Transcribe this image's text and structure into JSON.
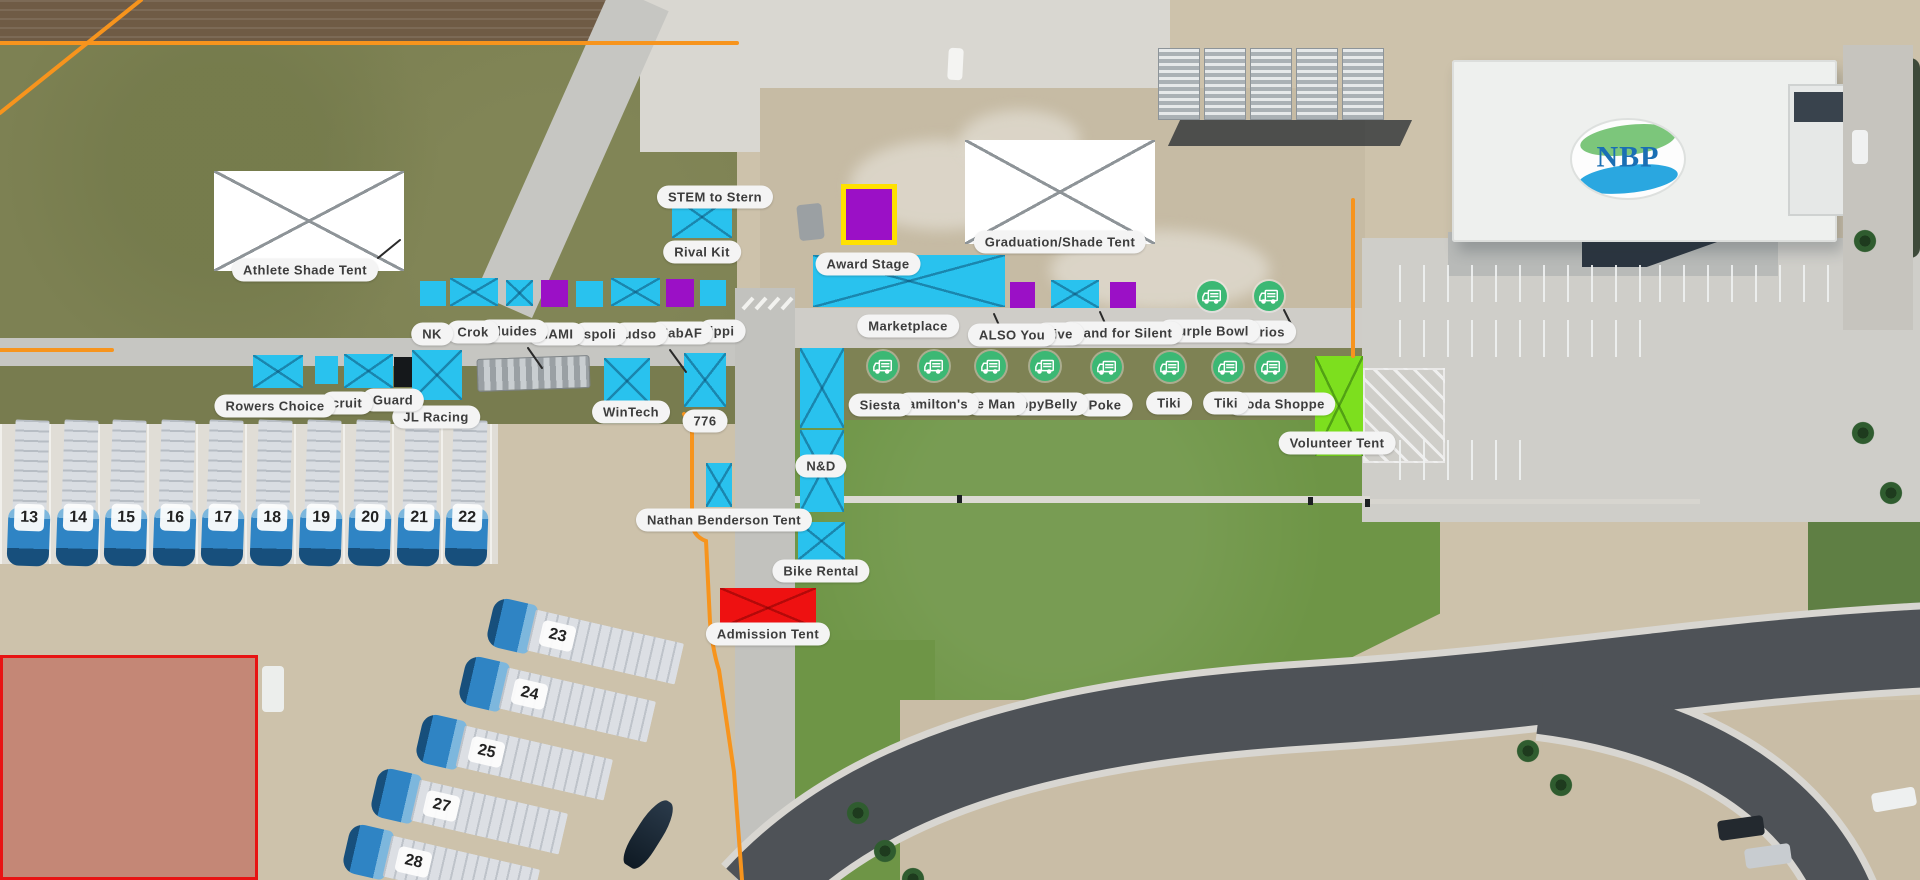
{
  "colors": {
    "tent-cyan": "#29c2ee",
    "tent-purple": "#9b10c6",
    "tent-red": "#ee1111",
    "tent-lime": "#7ddf1e",
    "stage-yellow": "#ffe100",
    "truck-green": "#3cb874",
    "boundary-orange": "#f7941d",
    "label-bg": "#f4f4f4",
    "label-text": "#3d3d3d",
    "zone-red": "#e81313"
  },
  "logo": {
    "text": "NBP"
  },
  "map": {
    "labels": [
      {
        "t": "Athlete Shade Tent",
        "x": 305,
        "y": 270
      },
      {
        "t": "STEM to Stern",
        "x": 715,
        "y": 197
      },
      {
        "t": "Rival Kit",
        "x": 702,
        "y": 252
      },
      {
        "t": "Award Stage",
        "x": 868,
        "y": 264
      },
      {
        "t": "Graduation/Shade Tent",
        "x": 1060,
        "y": 242
      },
      {
        "t": "Marketplace",
        "x": 908,
        "y": 326
      },
      {
        "t": "NK",
        "x": 432,
        "y": 334
      },
      {
        "t": "Crok",
        "x": 473,
        "y": 332
      },
      {
        "t": "Fluides",
        "x": 513,
        "y": 331
      },
      {
        "t": "NAMI",
        "x": 556,
        "y": 334
      },
      {
        "t": "spoli",
        "x": 600,
        "y": 334
      },
      {
        "t": "udso",
        "x": 640,
        "y": 334
      },
      {
        "t": "FabAF",
        "x": 681,
        "y": 333
      },
      {
        "t": "ippi",
        "x": 722,
        "y": 331
      },
      {
        "t": "ALSO You",
        "x": 1012,
        "y": 335
      },
      {
        "t": "Live",
        "x": 1059,
        "y": 334
      },
      {
        "t": "Stand for Silent",
        "x": 1121,
        "y": 333
      },
      {
        "t": "Purple Bowl",
        "x": 1209,
        "y": 331
      },
      {
        "t": "Frios",
        "x": 1268,
        "y": 332
      },
      {
        "t": "Rowers Choice",
        "x": 275,
        "y": 406
      },
      {
        "t": "cruit",
        "x": 347,
        "y": 403
      },
      {
        "t": "Guard",
        "x": 393,
        "y": 400
      },
      {
        "t": "JL Racing",
        "x": 436,
        "y": 417
      },
      {
        "t": "WinTech",
        "x": 631,
        "y": 412
      },
      {
        "t": "776",
        "x": 705,
        "y": 421
      },
      {
        "t": "Siesta",
        "x": 880,
        "y": 405
      },
      {
        "t": "amilton's",
        "x": 938,
        "y": 404
      },
      {
        "t": "e Man",
        "x": 996,
        "y": 404
      },
      {
        "t": "ppyBelly",
        "x": 1049,
        "y": 404
      },
      {
        "t": "Poke",
        "x": 1105,
        "y": 405
      },
      {
        "t": "Tiki",
        "x": 1169,
        "y": 403
      },
      {
        "t": "Tiki",
        "x": 1226,
        "y": 403
      },
      {
        "t": "Soda Shoppe",
        "x": 1281,
        "y": 404
      },
      {
        "t": "Volunteer Tent",
        "x": 1337,
        "y": 443
      },
      {
        "t": "N&D",
        "x": 821,
        "y": 466
      },
      {
        "t": "Nathan Benderson Tent",
        "x": 724,
        "y": 520
      },
      {
        "t": "Bike Rental",
        "x": 821,
        "y": 571
      },
      {
        "t": "Admission Tent",
        "x": 768,
        "y": 634
      }
    ],
    "tents": [
      {
        "n": "athlete-shade-tent",
        "c": "white",
        "x": 214,
        "y": 171,
        "w": 190,
        "h": 100,
        "xm": true
      },
      {
        "n": "graduation-shade-tent",
        "c": "white",
        "x": 965,
        "y": 140,
        "w": 190,
        "h": 104,
        "xm": true
      },
      {
        "n": "stage-square",
        "c": "purple",
        "x": 841,
        "y": 184,
        "w": 56,
        "h": 61,
        "border": "yellow"
      },
      {
        "n": "award-stage",
        "c": "cyan",
        "x": 813,
        "y": 255,
        "w": 192,
        "h": 52,
        "xm": true
      },
      {
        "n": "stem-to-stern-tent",
        "c": "cyan",
        "x": 672,
        "y": 196,
        "w": 60,
        "h": 42,
        "xm": true
      },
      {
        "n": "vendor-tent",
        "c": "cyan",
        "x": 420,
        "y": 281,
        "w": 26,
        "h": 25
      },
      {
        "n": "vendor-tent",
        "c": "cyan",
        "x": 450,
        "y": 278,
        "w": 48,
        "h": 28,
        "xm": true
      },
      {
        "n": "vendor-tent",
        "c": "cyan",
        "x": 506,
        "y": 280,
        "w": 27,
        "h": 26,
        "xm": true
      },
      {
        "n": "vendor-tent",
        "c": "purple",
        "x": 541,
        "y": 280,
        "w": 27,
        "h": 27
      },
      {
        "n": "vendor-tent",
        "c": "cyan",
        "x": 576,
        "y": 281,
        "w": 27,
        "h": 26
      },
      {
        "n": "vendor-tent",
        "c": "cyan",
        "x": 611,
        "y": 278,
        "w": 49,
        "h": 28,
        "xm": true
      },
      {
        "n": "vendor-tent",
        "c": "purple",
        "x": 666,
        "y": 279,
        "w": 28,
        "h": 28
      },
      {
        "n": "vendor-tent",
        "c": "cyan",
        "x": 700,
        "y": 280,
        "w": 26,
        "h": 26
      },
      {
        "n": "vendor-tent",
        "c": "purple",
        "x": 1010,
        "y": 282,
        "w": 25,
        "h": 26
      },
      {
        "n": "vendor-tent",
        "c": "cyan",
        "x": 1051,
        "y": 280,
        "w": 48,
        "h": 28,
        "xm": true
      },
      {
        "n": "vendor-tent",
        "c": "purple",
        "x": 1110,
        "y": 282,
        "w": 26,
        "h": 26
      },
      {
        "n": "vendor-tent",
        "c": "cyan",
        "x": 253,
        "y": 355,
        "w": 50,
        "h": 33,
        "xm": true
      },
      {
        "n": "vendor-tent",
        "c": "cyan",
        "x": 315,
        "y": 356,
        "w": 23,
        "h": 28
      },
      {
        "n": "vendor-tent",
        "c": "cyan",
        "x": 344,
        "y": 354,
        "w": 49,
        "h": 34,
        "xm": true
      },
      {
        "n": "vendor-tent",
        "c": "black",
        "x": 394,
        "y": 357,
        "w": 18,
        "h": 30
      },
      {
        "n": "vendor-tent",
        "c": "cyan",
        "x": 412,
        "y": 350,
        "w": 50,
        "h": 50,
        "xm": true
      },
      {
        "n": "wintech-tent",
        "c": "cyan",
        "x": 604,
        "y": 358,
        "w": 46,
        "h": 46,
        "xm": true
      },
      {
        "n": "776-tent",
        "c": "cyan",
        "x": 684,
        "y": 353,
        "w": 42,
        "h": 54,
        "xm": true
      },
      {
        "n": "nd-tent",
        "c": "cyan",
        "x": 800,
        "y": 348,
        "w": 44,
        "h": 80,
        "xm": true
      },
      {
        "n": "nd-tent",
        "c": "cyan",
        "x": 800,
        "y": 430,
        "w": 44,
        "h": 82,
        "xm": true
      },
      {
        "n": "path-tent",
        "c": "cyan",
        "x": 706,
        "y": 463,
        "w": 26,
        "h": 44,
        "xm": true
      },
      {
        "n": "bike-rental-tent",
        "c": "cyan",
        "x": 798,
        "y": 522,
        "w": 47,
        "h": 38,
        "xm": true
      },
      {
        "n": "admission-tent",
        "c": "red",
        "x": 720,
        "y": 588,
        "w": 96,
        "h": 40,
        "xm": true
      },
      {
        "n": "volunteer-tent",
        "c": "lime",
        "x": 1315,
        "y": 356,
        "w": 48,
        "h": 100,
        "xm": true
      }
    ],
    "food_trucks": [
      {
        "x": 883,
        "y": 366
      },
      {
        "x": 934,
        "y": 366
      },
      {
        "x": 991,
        "y": 366
      },
      {
        "x": 1045,
        "y": 366
      },
      {
        "x": 1107,
        "y": 367
      },
      {
        "x": 1170,
        "y": 367
      },
      {
        "x": 1228,
        "y": 367
      },
      {
        "x": 1271,
        "y": 367
      },
      {
        "x": 1212,
        "y": 296
      },
      {
        "x": 1269,
        "y": 296
      }
    ],
    "trailers_vertical": [
      {
        "n": 13,
        "x": 30
      },
      {
        "n": 14,
        "x": 79
      },
      {
        "n": 15,
        "x": 127
      },
      {
        "n": 16,
        "x": 176
      },
      {
        "n": 17,
        "x": 224
      },
      {
        "n": 18,
        "x": 273
      },
      {
        "n": 19,
        "x": 322
      },
      {
        "n": 20,
        "x": 371
      },
      {
        "n": 21,
        "x": 420
      },
      {
        "n": 22,
        "x": 468
      }
    ],
    "trailers_diagonal": [
      {
        "n": 23,
        "x": 490,
        "y": 598
      },
      {
        "n": 24,
        "x": 462,
        "y": 656
      },
      {
        "n": 25,
        "x": 419,
        "y": 714
      },
      {
        "n": 27,
        "x": 374,
        "y": 768
      },
      {
        "n": 28,
        "x": 346,
        "y": 824
      }
    ]
  }
}
